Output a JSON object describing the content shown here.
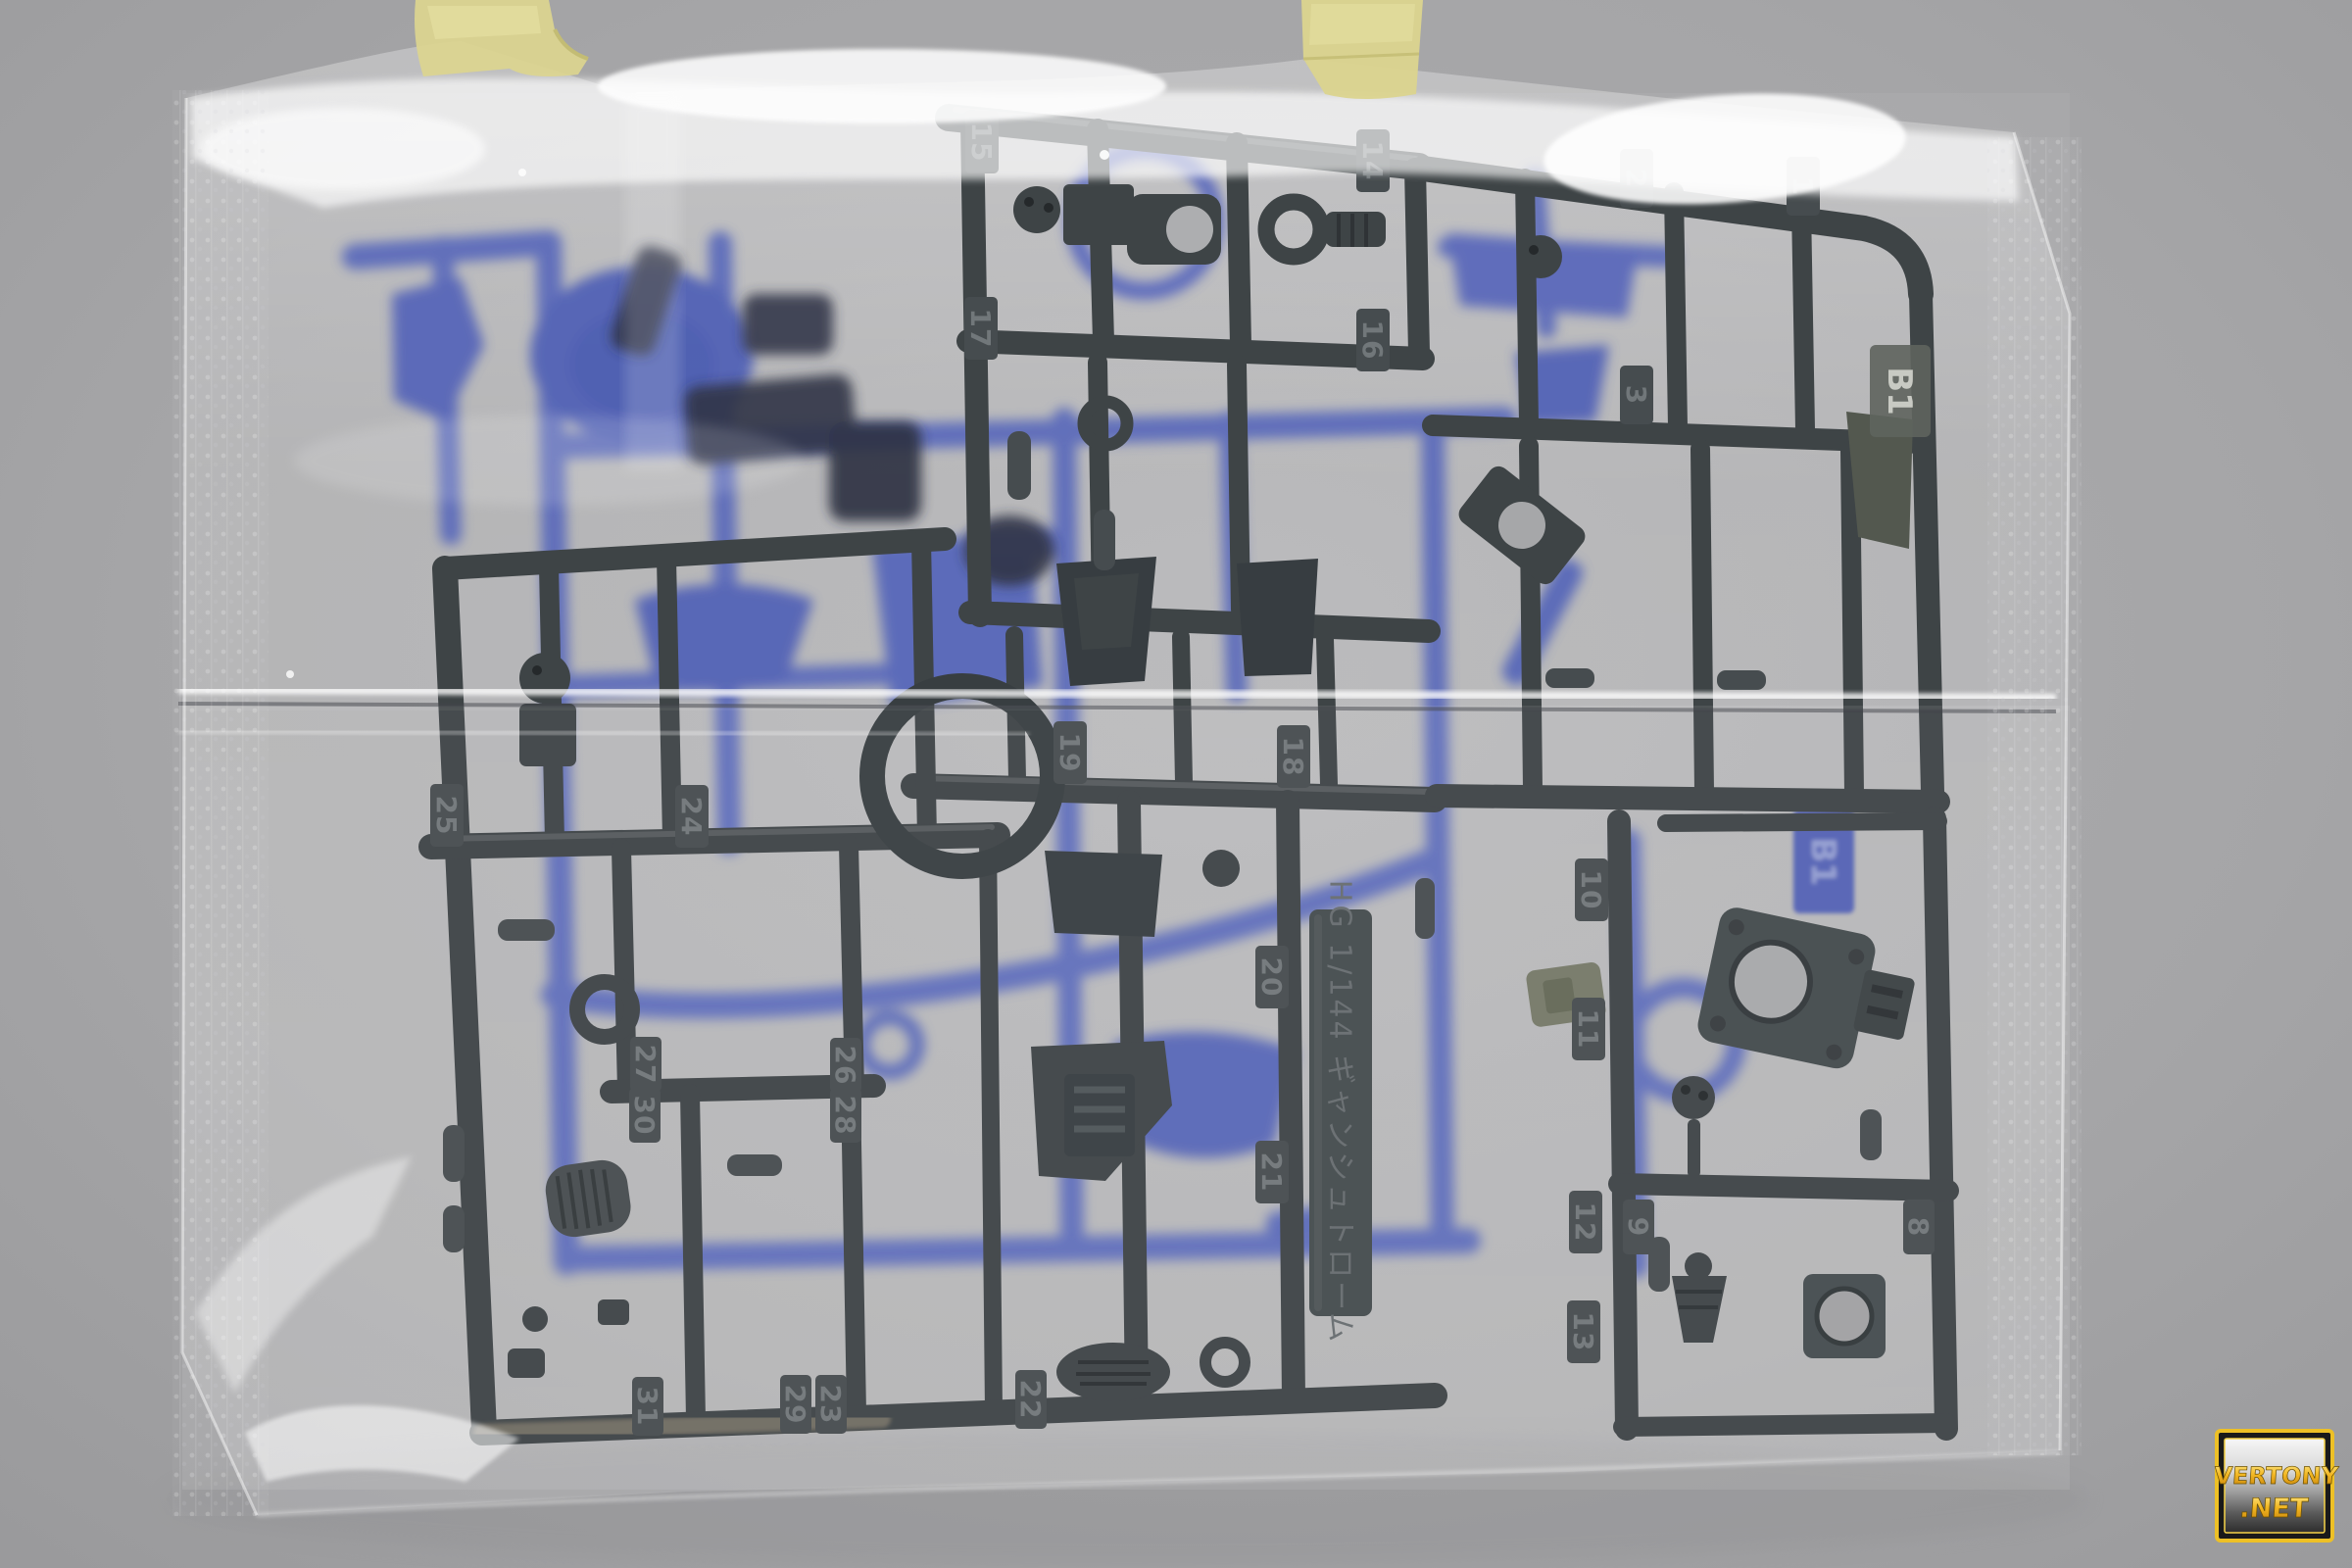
{
  "runner_tag": {
    "text": "HG 1/144 ギャンシュトローム"
  },
  "runner_codes": {
    "blue_tag": "B1",
    "dark_tag": "B1"
  },
  "part_numbers": {
    "n1": "1",
    "n2": "2",
    "n3": "3",
    "n8": "8",
    "n9": "9",
    "n10": "10",
    "n11": "11",
    "n12": "12",
    "n13": "13",
    "n14": "14",
    "n15": "15",
    "n16": "16",
    "n17": "17",
    "n18": "18",
    "n19": "19",
    "n20": "20",
    "n21": "21",
    "n22": "22",
    "n23": "23",
    "n24": "24",
    "n25": "25",
    "n26": "26",
    "n27": "27",
    "n28": "28",
    "n29": "29",
    "n30": "30",
    "n31": "31"
  },
  "watermark": {
    "line1": "VERTONY",
    "line2": ".NET"
  },
  "colors": {
    "wall": "#a5a5a7",
    "bag_highlight": "#ffffff",
    "tape": "#dcd58f",
    "dark_runner": "#343a3d",
    "dark_runner_tab": "#3d4346",
    "engraved_number": "#6a7073",
    "blue_runner": "#5565b8",
    "olive_part": "#6e7260",
    "watermark_gold": "#f0bc28",
    "tan_reflection": "#a8977c"
  }
}
